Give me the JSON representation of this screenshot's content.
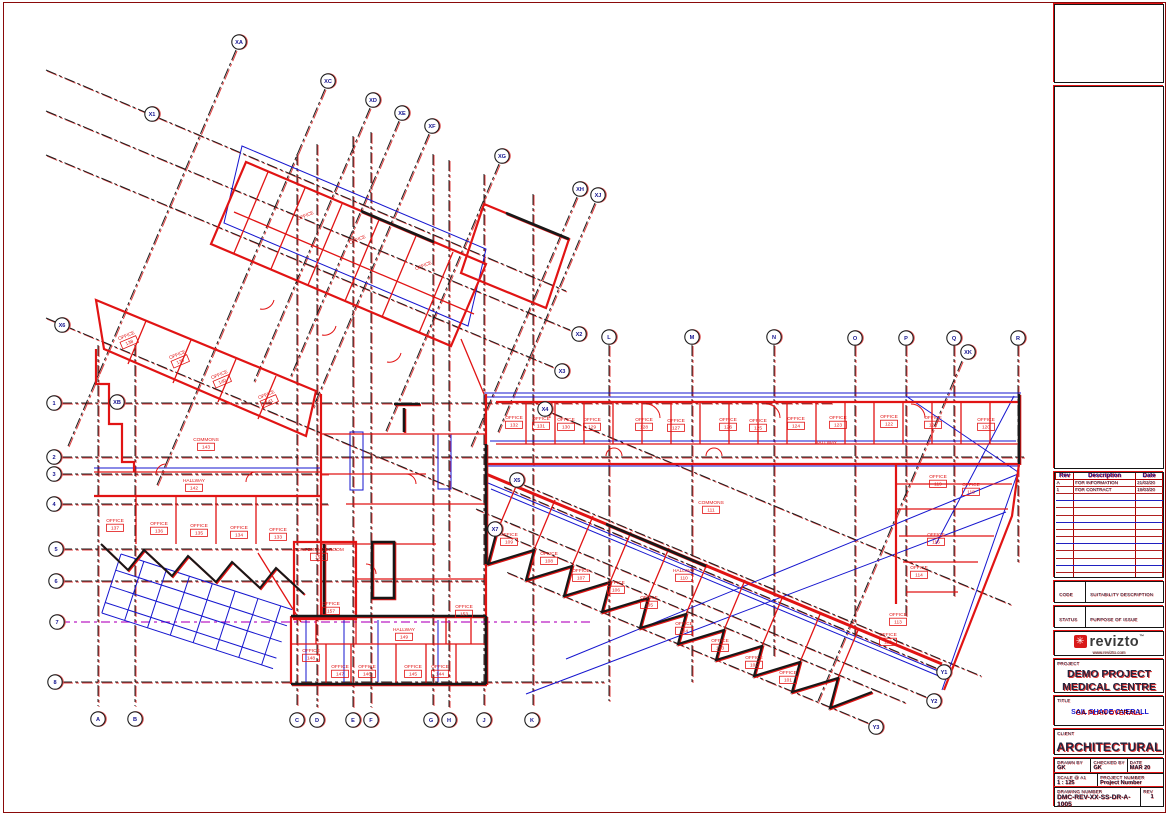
{
  "title_block": {
    "revision_table": {
      "headers": [
        "Rev",
        "Description",
        "Date"
      ],
      "rows": [
        [
          "A",
          "FOR INFORMATION",
          "21/02/20"
        ],
        [
          "1",
          "FOR CONTRACT",
          "19/03/20"
        ]
      ],
      "empty_rows": 13
    },
    "code_label": "CODE",
    "code_value": "SUITABILITY DESCRIPTION",
    "status_label": "STATUS",
    "status_value": "PURPOSE OF ISSUE",
    "logo": {
      "name": "revizto",
      "trademark": "™",
      "url": "www.revizto.com"
    },
    "project_label": "PROJECT",
    "project_name_line1": "DEMO PROJECT",
    "project_name_line2": "MEDICAL CENTRE",
    "title_label": "TITLE",
    "title_red": "GA PLAN OVERALL",
    "title_blue": "SAIL SHADE OVERALL",
    "client_label": "CLIENT",
    "client_value": "ARCHITECTURAL",
    "drawn_by_label": "DRAWN BY",
    "drawn_by": "GK",
    "checked_by_label": "CHECKED BY",
    "checked_by": "GK",
    "date_label": "DATE",
    "date": "MAR 20",
    "scale_label": "SCALE @ A1",
    "scale": "1 : 125",
    "project_number_label": "PROJECT NUMBER",
    "project_number": "Project Number",
    "drawing_number_label": "DRAWING NUMBER",
    "drawing_number": "DMC-REV-XX-SS-DR-A-1005",
    "rev_label": "REV",
    "rev": "1"
  },
  "drawing": {
    "colors": {
      "walls": "#e11414",
      "overlay": "#1616cf",
      "gridline": "#1c1c1c",
      "bubble_text": "#14148f",
      "marker": "#bb1fc4"
    },
    "grid_bubbles": [
      {
        "label": "XA",
        "x": 233,
        "y": 38
      },
      {
        "label": "XC",
        "x": 322,
        "y": 77
      },
      {
        "label": "XD",
        "x": 367,
        "y": 96
      },
      {
        "label": "XE",
        "x": 396,
        "y": 109
      },
      {
        "label": "XF",
        "x": 426,
        "y": 122
      },
      {
        "label": "XG",
        "x": 496,
        "y": 152
      },
      {
        "label": "XH",
        "x": 574,
        "y": 185
      },
      {
        "label": "XJ",
        "x": 592,
        "y": 191
      },
      {
        "label": "X1",
        "x": 146,
        "y": 110
      },
      {
        "label": "X2",
        "x": 573,
        "y": 330
      },
      {
        "label": "X3",
        "x": 556,
        "y": 367
      },
      {
        "label": "X4",
        "x": 539,
        "y": 405
      },
      {
        "label": "X5",
        "x": 511,
        "y": 476
      },
      {
        "label": "X7",
        "x": 489,
        "y": 525
      },
      {
        "label": "X6",
        "x": 56,
        "y": 321
      },
      {
        "label": "XB",
        "x": 111,
        "y": 398
      },
      {
        "label": "XK",
        "x": 962,
        "y": 348
      },
      {
        "label": "1",
        "x": 48,
        "y": 399
      },
      {
        "label": "2",
        "x": 48,
        "y": 453
      },
      {
        "label": "3",
        "x": 48,
        "y": 470
      },
      {
        "label": "4",
        "x": 48,
        "y": 500
      },
      {
        "label": "5",
        "x": 50,
        "y": 545
      },
      {
        "label": "6",
        "x": 50,
        "y": 577
      },
      {
        "label": "7",
        "x": 51,
        "y": 618
      },
      {
        "label": "8",
        "x": 49,
        "y": 678
      },
      {
        "label": "A",
        "x": 92,
        "y": 715
      },
      {
        "label": "B",
        "x": 129,
        "y": 715
      },
      {
        "label": "C",
        "x": 291,
        "y": 716
      },
      {
        "label": "D",
        "x": 311,
        "y": 716
      },
      {
        "label": "E",
        "x": 347,
        "y": 716
      },
      {
        "label": "F",
        "x": 365,
        "y": 716
      },
      {
        "label": "G",
        "x": 425,
        "y": 716
      },
      {
        "label": "H",
        "x": 443,
        "y": 716
      },
      {
        "label": "J",
        "x": 478,
        "y": 716
      },
      {
        "label": "K",
        "x": 526,
        "y": 716
      },
      {
        "label": "L",
        "x": 603,
        "y": 333
      },
      {
        "label": "M",
        "x": 686,
        "y": 333
      },
      {
        "label": "N",
        "x": 768,
        "y": 333
      },
      {
        "label": "O",
        "x": 849,
        "y": 334
      },
      {
        "label": "P",
        "x": 900,
        "y": 334
      },
      {
        "label": "Q",
        "x": 948,
        "y": 334
      },
      {
        "label": "R",
        "x": 1012,
        "y": 334
      },
      {
        "label": "Y1",
        "x": 938,
        "y": 668
      },
      {
        "label": "Y2",
        "x": 928,
        "y": 697
      },
      {
        "label": "Y3",
        "x": 870,
        "y": 723
      }
    ],
    "rooms": [
      {
        "name": "OFFICE",
        "num": "",
        "x": 300,
        "y": 213,
        "rot": -23
      },
      {
        "name": "OFFICE",
        "num": "",
        "x": 352,
        "y": 237,
        "rot": -23
      },
      {
        "name": "OFFICE",
        "num": "",
        "x": 418,
        "y": 263,
        "rot": -23
      },
      {
        "name": "OFFICE",
        "num": "138",
        "x": 121,
        "y": 333,
        "rot": -23
      },
      {
        "name": "OFFICE",
        "num": "139",
        "x": 172,
        "y": 352,
        "rot": -23
      },
      {
        "name": "OFFICE",
        "num": "140",
        "x": 214,
        "y": 372,
        "rot": -23
      },
      {
        "name": "OFFICE",
        "num": "141",
        "x": 261,
        "y": 392,
        "rot": -23
      },
      {
        "name": "COMMONS",
        "num": "143",
        "x": 200,
        "y": 437,
        "rot": 0
      },
      {
        "name": "HALLWAY",
        "num": "142",
        "x": 188,
        "y": 478,
        "rot": 0
      },
      {
        "name": "OFFICE",
        "num": "137",
        "x": 109,
        "y": 518,
        "rot": 0
      },
      {
        "name": "OFFICE",
        "num": "136",
        "x": 153,
        "y": 521,
        "rot": 0
      },
      {
        "name": "OFFICE",
        "num": "135",
        "x": 193,
        "y": 523,
        "rot": 0
      },
      {
        "name": "OFFICE",
        "num": "134",
        "x": 233,
        "y": 525,
        "rot": 0
      },
      {
        "name": "OFFICE",
        "num": "133",
        "x": 272,
        "y": 527,
        "rot": 0
      },
      {
        "name": "CONFERENCE ROOM",
        "num": "152",
        "x": 313,
        "y": 547,
        "rot": 0
      },
      {
        "name": "OFFICE",
        "num": "157",
        "x": 325,
        "y": 601,
        "rot": 0
      },
      {
        "name": "OFFICE",
        "num": "153",
        "x": 458,
        "y": 604,
        "rot": 0
      },
      {
        "name": "OFFICE",
        "num": "148",
        "x": 305,
        "y": 648,
        "rot": 0
      },
      {
        "name": "OFFICE",
        "num": "147",
        "x": 334,
        "y": 664,
        "rot": 0
      },
      {
        "name": "OFFICE",
        "num": "146",
        "x": 361,
        "y": 664,
        "rot": 0
      },
      {
        "name": "OFFICE",
        "num": "145",
        "x": 407,
        "y": 664,
        "rot": 0
      },
      {
        "name": "OFFICE",
        "num": "144",
        "x": 434,
        "y": 664,
        "rot": 0
      },
      {
        "name": "HALLWAY",
        "num": "149",
        "x": 398,
        "y": 627,
        "rot": 0
      },
      {
        "name": "OFFICE",
        "num": "132",
        "x": 508,
        "y": 415,
        "rot": 0
      },
      {
        "name": "OFFICE",
        "num": "131",
        "x": 535,
        "y": 416,
        "rot": 0
      },
      {
        "name": "OFFICE",
        "num": "130",
        "x": 560,
        "y": 417,
        "rot": 0
      },
      {
        "name": "OFFICE",
        "num": "129",
        "x": 586,
        "y": 417,
        "rot": 0
      },
      {
        "name": "OFFICE",
        "num": "128",
        "x": 638,
        "y": 417,
        "rot": 0
      },
      {
        "name": "OFFICE",
        "num": "127",
        "x": 670,
        "y": 418,
        "rot": 0
      },
      {
        "name": "OFFICE",
        "num": "126",
        "x": 722,
        "y": 417,
        "rot": 0
      },
      {
        "name": "OFFICE",
        "num": "125",
        "x": 752,
        "y": 418,
        "rot": 0
      },
      {
        "name": "OFFICE",
        "num": "124",
        "x": 790,
        "y": 416,
        "rot": 0
      },
      {
        "name": "OFFICE",
        "num": "123",
        "x": 832,
        "y": 415,
        "rot": 0
      },
      {
        "name": "OFFICE",
        "num": "122",
        "x": 883,
        "y": 414,
        "rot": 0
      },
      {
        "name": "OFFICE",
        "num": "121",
        "x": 927,
        "y": 415,
        "rot": 0
      },
      {
        "name": "OFFICE",
        "num": "120",
        "x": 980,
        "y": 417,
        "rot": 0
      },
      {
        "name": "HALLWAY",
        "num": "",
        "x": 820,
        "y": 440,
        "rot": 0
      },
      {
        "name": "COMMONS",
        "num": "111",
        "x": 705,
        "y": 500,
        "rot": 0
      },
      {
        "name": "OFFICE",
        "num": "119",
        "x": 932,
        "y": 474,
        "rot": 0
      },
      {
        "name": "OFFICE",
        "num": "118",
        "x": 965,
        "y": 482,
        "rot": 0
      },
      {
        "name": "OFFICE",
        "num": "116",
        "x": 930,
        "y": 532,
        "rot": 0
      },
      {
        "name": "OFFICE",
        "num": "114",
        "x": 913,
        "y": 565,
        "rot": 0
      },
      {
        "name": "OFFICE",
        "num": "113",
        "x": 892,
        "y": 612,
        "rot": 0
      },
      {
        "name": "OFFICE",
        "num": "112",
        "x": 882,
        "y": 632,
        "rot": 0
      },
      {
        "name": "OFFICE",
        "num": "109",
        "x": 503,
        "y": 532,
        "rot": 0
      },
      {
        "name": "OFFICE",
        "num": "108",
        "x": 543,
        "y": 551,
        "rot": 0
      },
      {
        "name": "OFFICE",
        "num": "107",
        "x": 575,
        "y": 568,
        "rot": 0
      },
      {
        "name": "OFFICE",
        "num": "106",
        "x": 610,
        "y": 580,
        "rot": 0
      },
      {
        "name": "OFFICE",
        "num": "105",
        "x": 643,
        "y": 595,
        "rot": 0
      },
      {
        "name": "HALLWAY",
        "num": "110",
        "x": 678,
        "y": 568,
        "rot": 0
      },
      {
        "name": "OFFICE",
        "num": "104",
        "x": 678,
        "y": 621,
        "rot": 0
      },
      {
        "name": "OFFICE",
        "num": "103",
        "x": 714,
        "y": 638,
        "rot": 0
      },
      {
        "name": "OFFICE",
        "num": "102",
        "x": 748,
        "y": 655,
        "rot": 0
      },
      {
        "name": "OFFICE",
        "num": "101",
        "x": 782,
        "y": 670,
        "rot": 0
      }
    ]
  }
}
